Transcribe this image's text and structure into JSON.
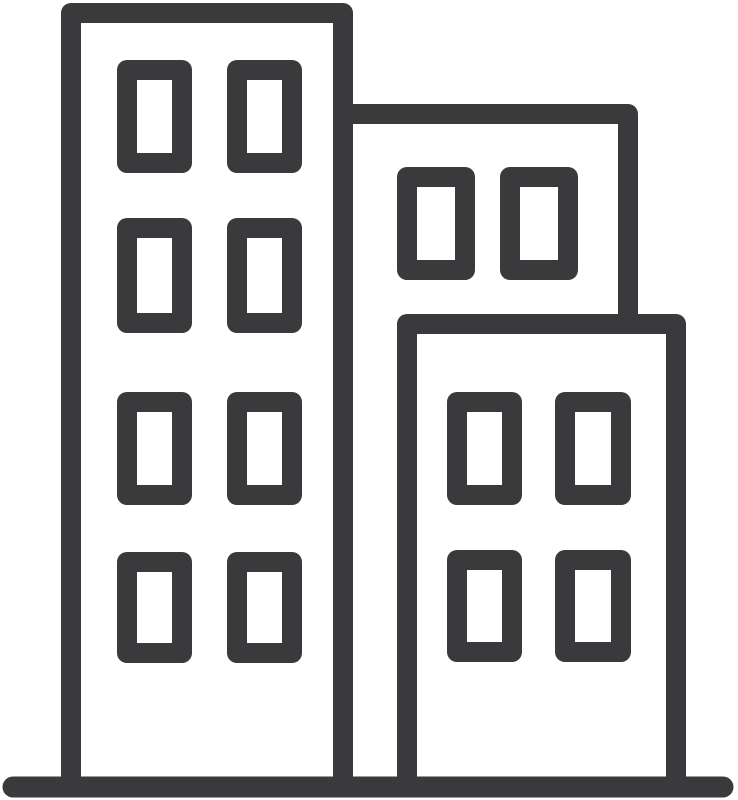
{
  "canvas": {
    "width": 738,
    "height": 800,
    "background_color": "#ffffff"
  },
  "icon": {
    "name": "city-buildings-icon",
    "description": "outline icon of three office buildings with windows standing on a ground line",
    "stroke_color": "#3a3a3c",
    "stroke_width": 20,
    "buildings": [
      {
        "id": "left-tower",
        "outline_path": "M71,790 L71,13 L343,13 L343,790",
        "windows": [
          {
            "x": 127,
            "y": 70,
            "w": 55,
            "h": 93
          },
          {
            "x": 237,
            "y": 70,
            "w": 55,
            "h": 93
          },
          {
            "x": 127,
            "y": 228,
            "w": 55,
            "h": 95
          },
          {
            "x": 237,
            "y": 228,
            "w": 55,
            "h": 95
          },
          {
            "x": 127,
            "y": 402,
            "w": 55,
            "h": 93
          },
          {
            "x": 237,
            "y": 402,
            "w": 55,
            "h": 93
          },
          {
            "x": 127,
            "y": 562,
            "w": 55,
            "h": 91
          },
          {
            "x": 237,
            "y": 562,
            "w": 55,
            "h": 91
          }
        ]
      },
      {
        "id": "middle-tower",
        "outline_path": "M343,114 L628,114 L628,330",
        "windows": [
          {
            "x": 407,
            "y": 177,
            "w": 58,
            "h": 93
          },
          {
            "x": 510,
            "y": 177,
            "w": 58,
            "h": 93
          }
        ]
      },
      {
        "id": "right-tower",
        "outline_path": "M407,790 L407,324 L676,324 L676,790",
        "windows": [
          {
            "x": 457,
            "y": 402,
            "w": 55,
            "h": 93
          },
          {
            "x": 565,
            "y": 402,
            "w": 56,
            "h": 93
          },
          {
            "x": 457,
            "y": 560,
            "w": 55,
            "h": 92
          },
          {
            "x": 565,
            "y": 560,
            "w": 56,
            "h": 92
          }
        ]
      }
    ],
    "ground": {
      "x1": 13,
      "y1": 787,
      "x2": 723,
      "y2": 787,
      "stroke_width": 21
    }
  }
}
